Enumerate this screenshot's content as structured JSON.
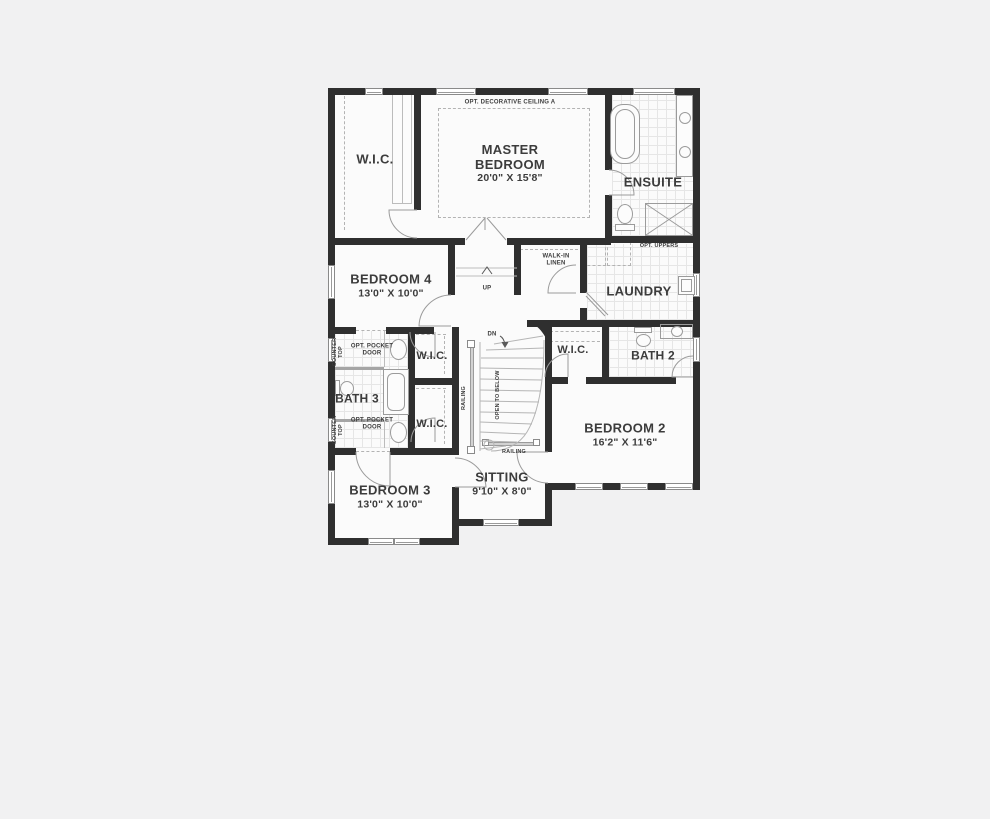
{
  "canvas": {
    "width": 990,
    "height": 819,
    "background": "#f1f1f2"
  },
  "colors": {
    "wall": "#2f2f2f",
    "floor": "#fbfbfb",
    "background": "#f1f1f2",
    "line": "#9b9b9b",
    "tile": "#e6e6e6",
    "text": "#3c3c3c"
  },
  "rooms": {
    "wic_master": {
      "name": "W.I.C."
    },
    "master_bedroom": {
      "name": "MASTER BEDROOM",
      "dims": "20'0\" X 15'8\""
    },
    "ensuite": {
      "name": "ENSUITE"
    },
    "bedroom4": {
      "name": "BEDROOM 4",
      "dims": "13'0\" X 10'0\""
    },
    "walk_in_linen": {
      "name": "WALK-IN LINEN"
    },
    "laundry": {
      "name": "LAUNDRY"
    },
    "bath3": {
      "name": "BATH 3"
    },
    "wic_bedroom4": {
      "name": "W.I.C."
    },
    "wic_bedroom3": {
      "name": "W.I.C."
    },
    "wic_bedroom2": {
      "name": "W.I.C."
    },
    "bath2": {
      "name": "BATH 2"
    },
    "bedroom2": {
      "name": "BEDROOM 2",
      "dims": "16'2\" X 11'6\""
    },
    "sitting": {
      "name": "SITTING",
      "dims": "9'10\" X 8'0\""
    },
    "bedroom3": {
      "name": "BEDROOM 3",
      "dims": "13'0\" X 10'0\""
    }
  },
  "annotations": {
    "decorative_ceiling": "OPT. DECORATIVE CEILING A",
    "opt_uppers": "OPT. UPPERS",
    "up": "UP",
    "dn": "DN",
    "railing_side": "RAILING",
    "railing_bottom": "RAILING",
    "open_to_below": "OPEN TO BELOW",
    "opt_pocket_door_top": "OPT. POCKET DOOR",
    "opt_pocket_door_bottom": "OPT. POCKET DOOR",
    "counter_top_upper": "COUNTER TOP",
    "counter_top_lower": "COUNTER TOP"
  },
  "fixtures": [
    "bathtub",
    "double-sink-vanity",
    "toilet",
    "shower",
    "laundry-tub",
    "sink",
    "curved-staircase",
    "window",
    "door"
  ]
}
